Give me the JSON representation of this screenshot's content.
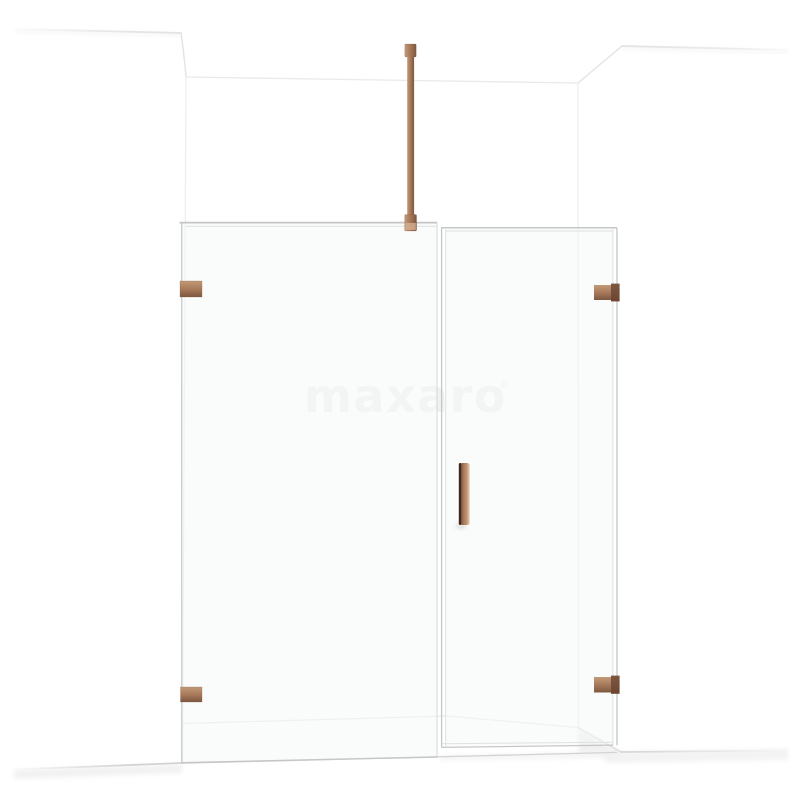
{
  "watermark": {
    "text": "maxaro",
    "registered_mark": "®",
    "color": "#f1f1f1"
  },
  "palette": {
    "background": "#ffffff",
    "wall_line": "#e3e3e3",
    "wall_line_faint": "#ededed",
    "floor_line": "#d3d3d3",
    "shadow_soft": "#ececec",
    "glass_line": "#c4c6c7",
    "glass_line_light": "#dfe1e1",
    "glass_fill": "#f5f7f7",
    "copper": "#a87a5a",
    "copper_light": "#c29a77",
    "copper_dark": "#7d5740",
    "copper_deep": "#6b4530",
    "copper_deepest": "#42281c",
    "copper_pale": "#d4b091"
  }
}
